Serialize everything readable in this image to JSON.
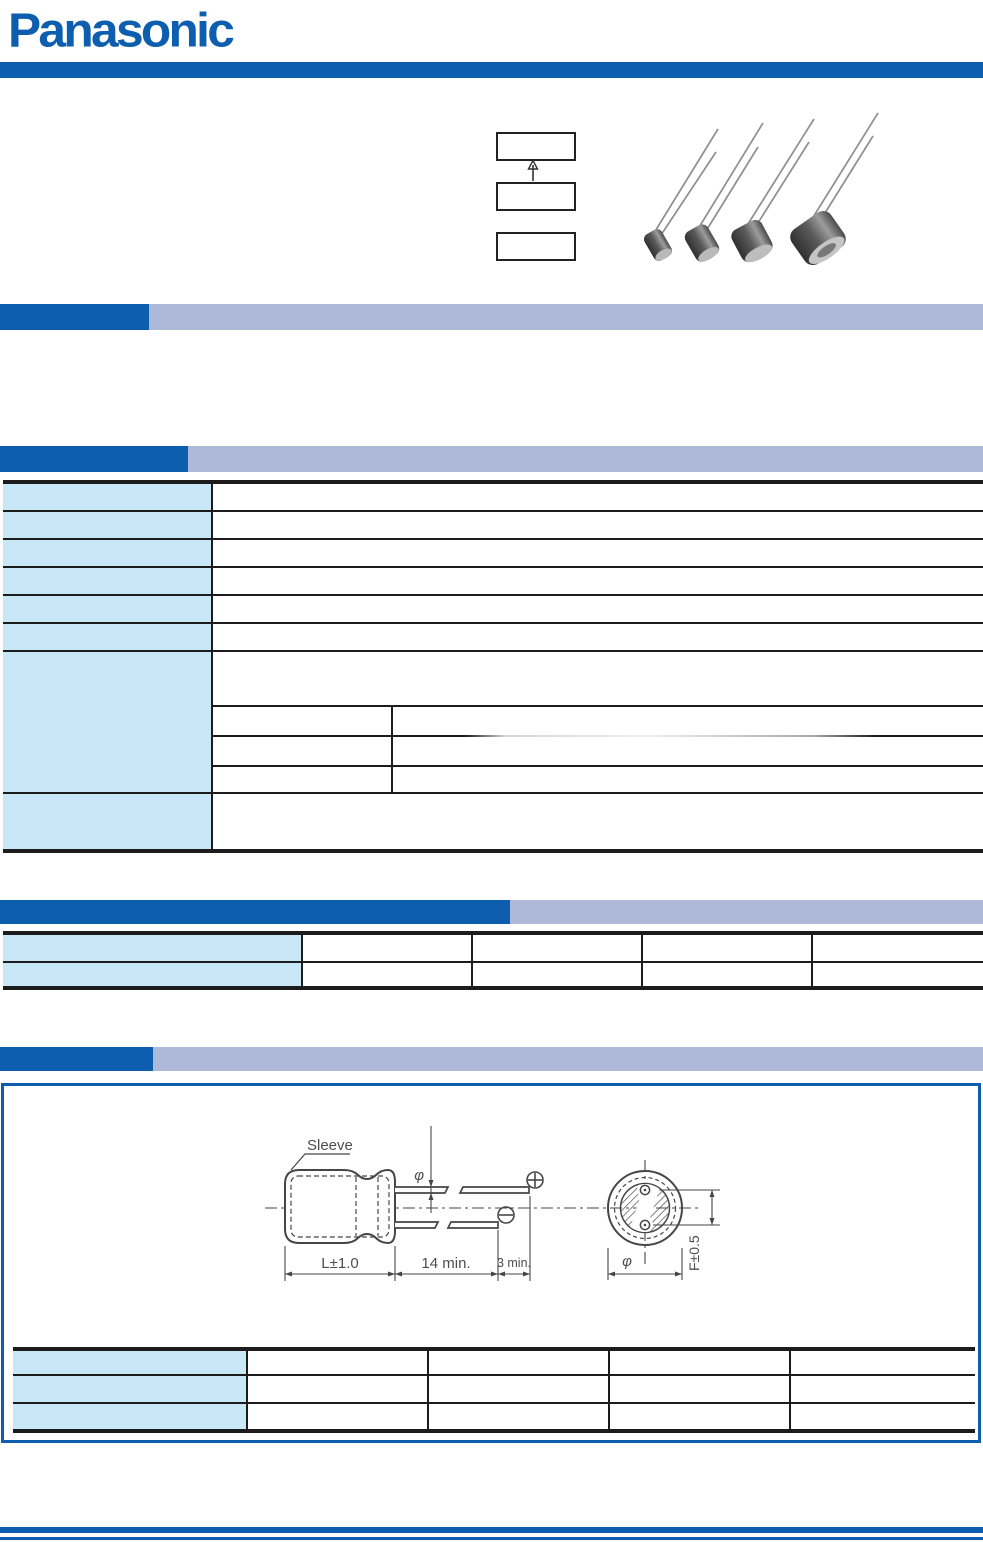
{
  "brand": {
    "logo": "Panasonic"
  },
  "colors": {
    "blue": "#0d5eae",
    "lavender": "#aeb9da",
    "cell": "#c9e8f7",
    "ink": "#1c1c1c",
    "line-gray": "#464646"
  },
  "drawing": {
    "sleeve_label": "Sleeve",
    "length_dim": "L±1.0",
    "lead_length_dim": "14 min.",
    "lead_tip_dim": "3 min.",
    "lead_diameter_symbol": "φ",
    "case_diameter_symbol": "φ",
    "lead_spacing_dim": "F±0.5"
  }
}
